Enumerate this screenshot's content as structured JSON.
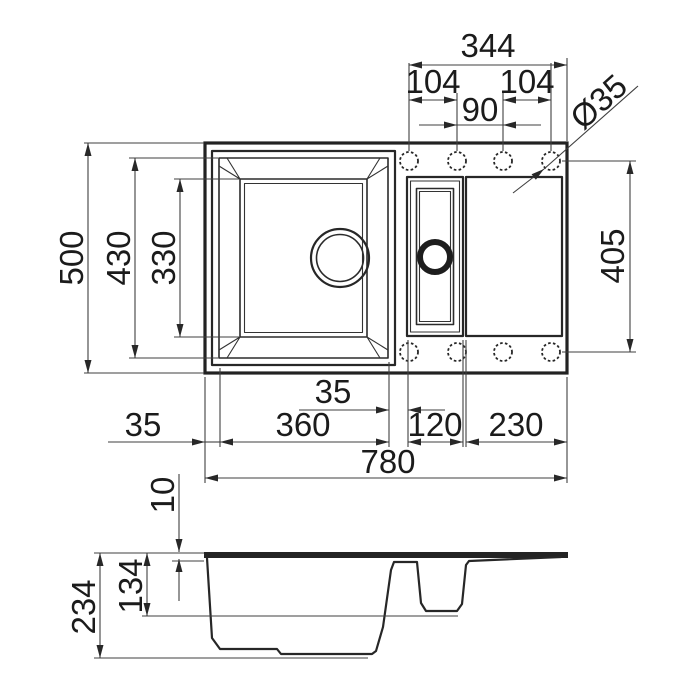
{
  "ink_color": "#222222",
  "background_color": "#ffffff",
  "top_view": {
    "hole_span": "344",
    "hole_pitch_left": "104",
    "hole_pitch_center": "90",
    "hole_pitch_right": "104",
    "tap_hole_diameter": "Ø35",
    "overall_depth": "500",
    "bowl_cutout_depth": "430",
    "bowl_base_depth": "330",
    "hole_row_span": "405",
    "bowl_gap": "35",
    "left_rim_width": "35",
    "main_bowl_width": "360",
    "half_bowl_width": "120",
    "drainer_width": "230",
    "overall_width": "780"
  },
  "side_view": {
    "rim_thickness": "10",
    "half_bowl_depth": "134",
    "total_depth": "234"
  }
}
